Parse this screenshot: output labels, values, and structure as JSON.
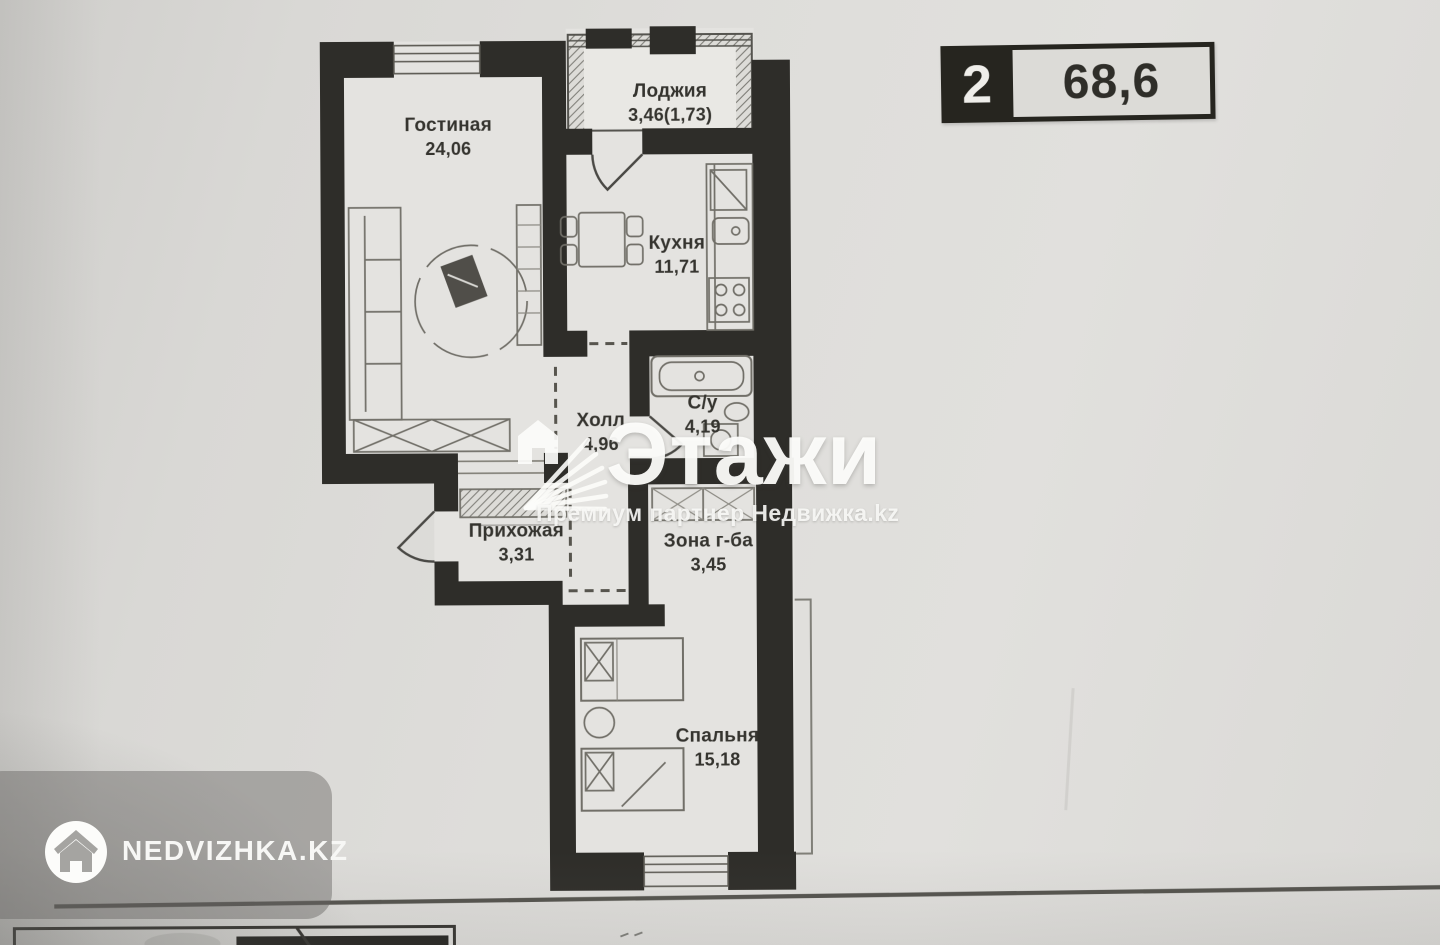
{
  "badge": {
    "rooms_count": "2",
    "total_area": "68,6"
  },
  "rooms": [
    {
      "key": "gostinaya",
      "name": "Гостиная",
      "area": "24,06"
    },
    {
      "key": "lodzhiya",
      "name": "Лоджия",
      "area": "3,46(1,73)"
    },
    {
      "key": "kuhnya",
      "name": "Кухня",
      "area": "11,71"
    },
    {
      "key": "holl",
      "name": "Холл",
      "area": "4,96"
    },
    {
      "key": "sanuzel",
      "name": "С/у",
      "area": "4,19"
    },
    {
      "key": "prihozhaya",
      "name": "Прихожая",
      "area": "3,31"
    },
    {
      "key": "zona_garderoba",
      "name": "Зона г-ба",
      "area": "3,45"
    },
    {
      "key": "spalnya",
      "name": "Спальня",
      "area": "15,18"
    }
  ],
  "watermark": {
    "brand": "Этажи",
    "subtitle": "Премиум партнер Недвижка.kz"
  },
  "footer_logo": {
    "site": "NEDVIZHKA.KZ"
  },
  "icons": {
    "etazhi_logo": "fan-house-icon",
    "nedvizhka_logo": "house-in-circle-icon"
  },
  "colors": {
    "paper": "#e4e3e0",
    "wall": "#2e2d29",
    "badge_dark": "#26251f",
    "watermark_white": "#fbfbf9",
    "overlay_gray": "#9e9d9a"
  }
}
